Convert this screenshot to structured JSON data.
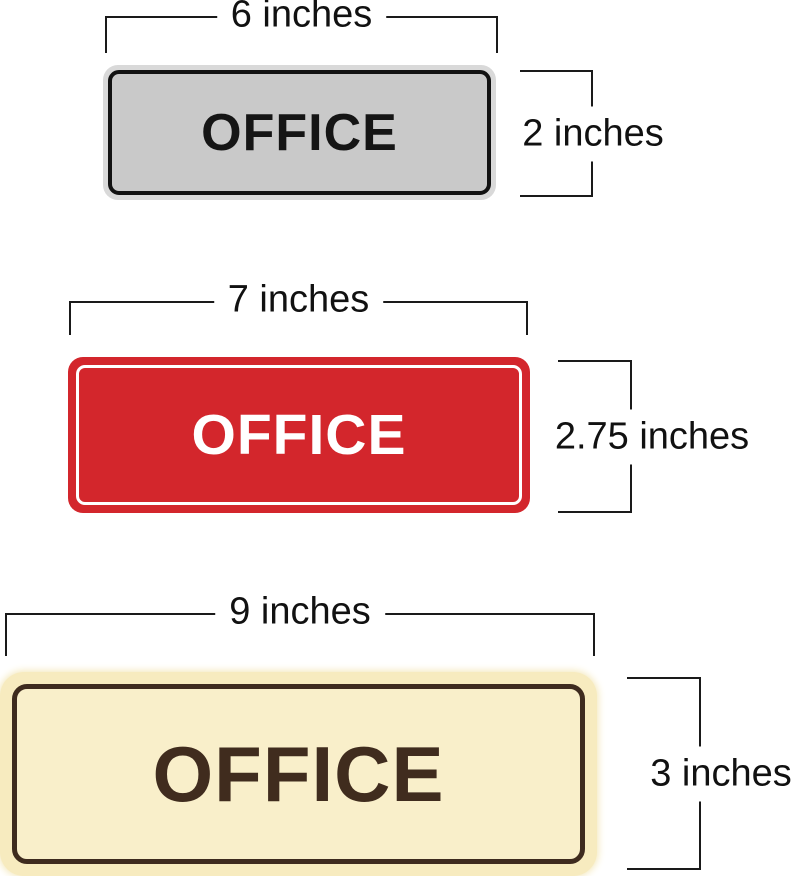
{
  "page": {
    "background": "#ffffff",
    "dimension_line_color": "#1a1a1a"
  },
  "signs": [
    {
      "name": "small-gray-office-sign",
      "label": "OFFICE",
      "width_label": "6 inches",
      "height_label": "2 inches",
      "colors": {
        "rim": "#d9d9d9",
        "face": "#c9c9c9",
        "border": "#121212",
        "text": "#151515"
      }
    },
    {
      "name": "medium-red-office-sign",
      "label": "OFFICE",
      "width_label": "7 inches",
      "height_label": "2.75 inches",
      "colors": {
        "face": "#d3262c",
        "outline": "#ffffff",
        "text": "#ffffff"
      }
    },
    {
      "name": "large-cream-office-sign",
      "label": "OFFICE",
      "width_label": "9 inches",
      "height_label": "3 inches",
      "colors": {
        "glow": "#f7ebbf",
        "face": "#f9efca",
        "border": "#3e2b1e",
        "text": "#402c1e"
      }
    }
  ]
}
